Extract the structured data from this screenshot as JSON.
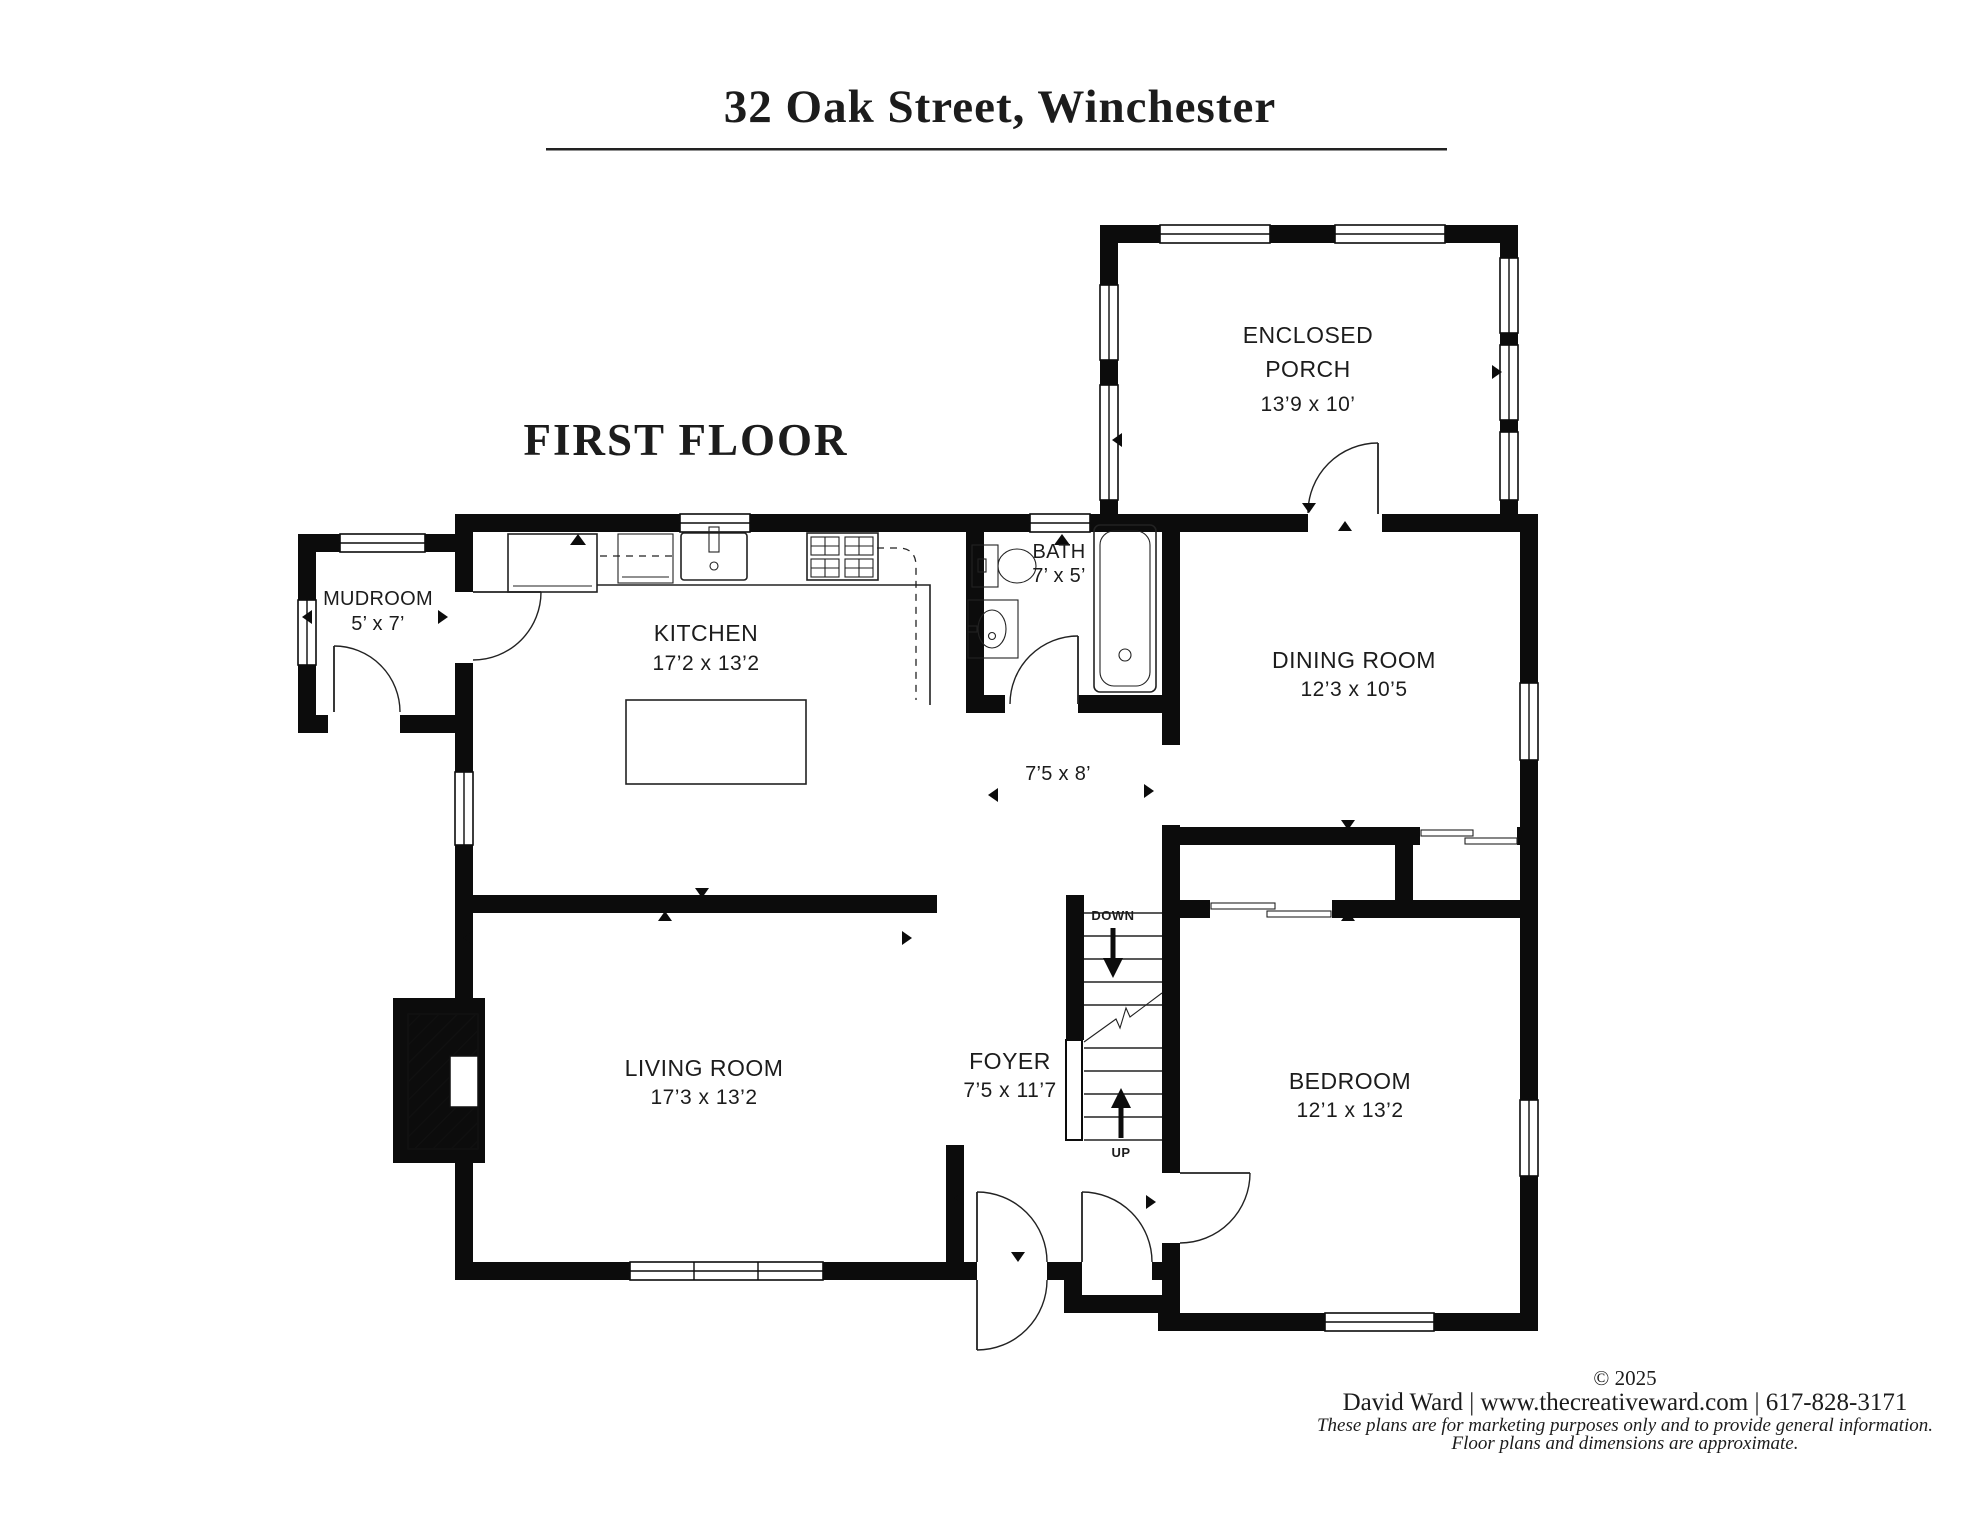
{
  "header": {
    "title": "32 Oak Street, Winchester",
    "floor_label": "FIRST FLOOR"
  },
  "rooms": {
    "enclosed_porch": {
      "line1": "ENCLOSED",
      "line2": "PORCH",
      "dims": "13’9 x 10’"
    },
    "mudroom": {
      "name": "MUDROOM",
      "dims": "5’ x 7’"
    },
    "kitchen": {
      "name": "KITCHEN",
      "dims": "17’2 x 13’2"
    },
    "bath": {
      "name": "BATH",
      "dims": "7’ x 5’"
    },
    "dining_room": {
      "name": "DINING ROOM",
      "dims": "12’3 x 10’5"
    },
    "hallway": {
      "dims": "7’5 x 8’"
    },
    "living_room": {
      "name": "LIVING ROOM",
      "dims": "17’3 x 13’2"
    },
    "foyer": {
      "name": "FOYER",
      "dims": "7’5 x 11’7"
    },
    "bedroom": {
      "name": "BEDROOM",
      "dims": "12’1 x 13’2"
    }
  },
  "stairs": {
    "down_label": "DOWN",
    "up_label": "UP"
  },
  "footer": {
    "copyright": "© 2025",
    "contact": "David Ward  |  www.thecreativeward.com  |  617-828-3171",
    "disclaimer_line1": "These plans are for marketing purposes only and to provide general information.",
    "disclaimer_line2": "Floor plans and dimensions are approximate."
  },
  "colors": {
    "walls": "#0c0c0c",
    "background": "#ffffff",
    "text": "#1c1c1c"
  }
}
